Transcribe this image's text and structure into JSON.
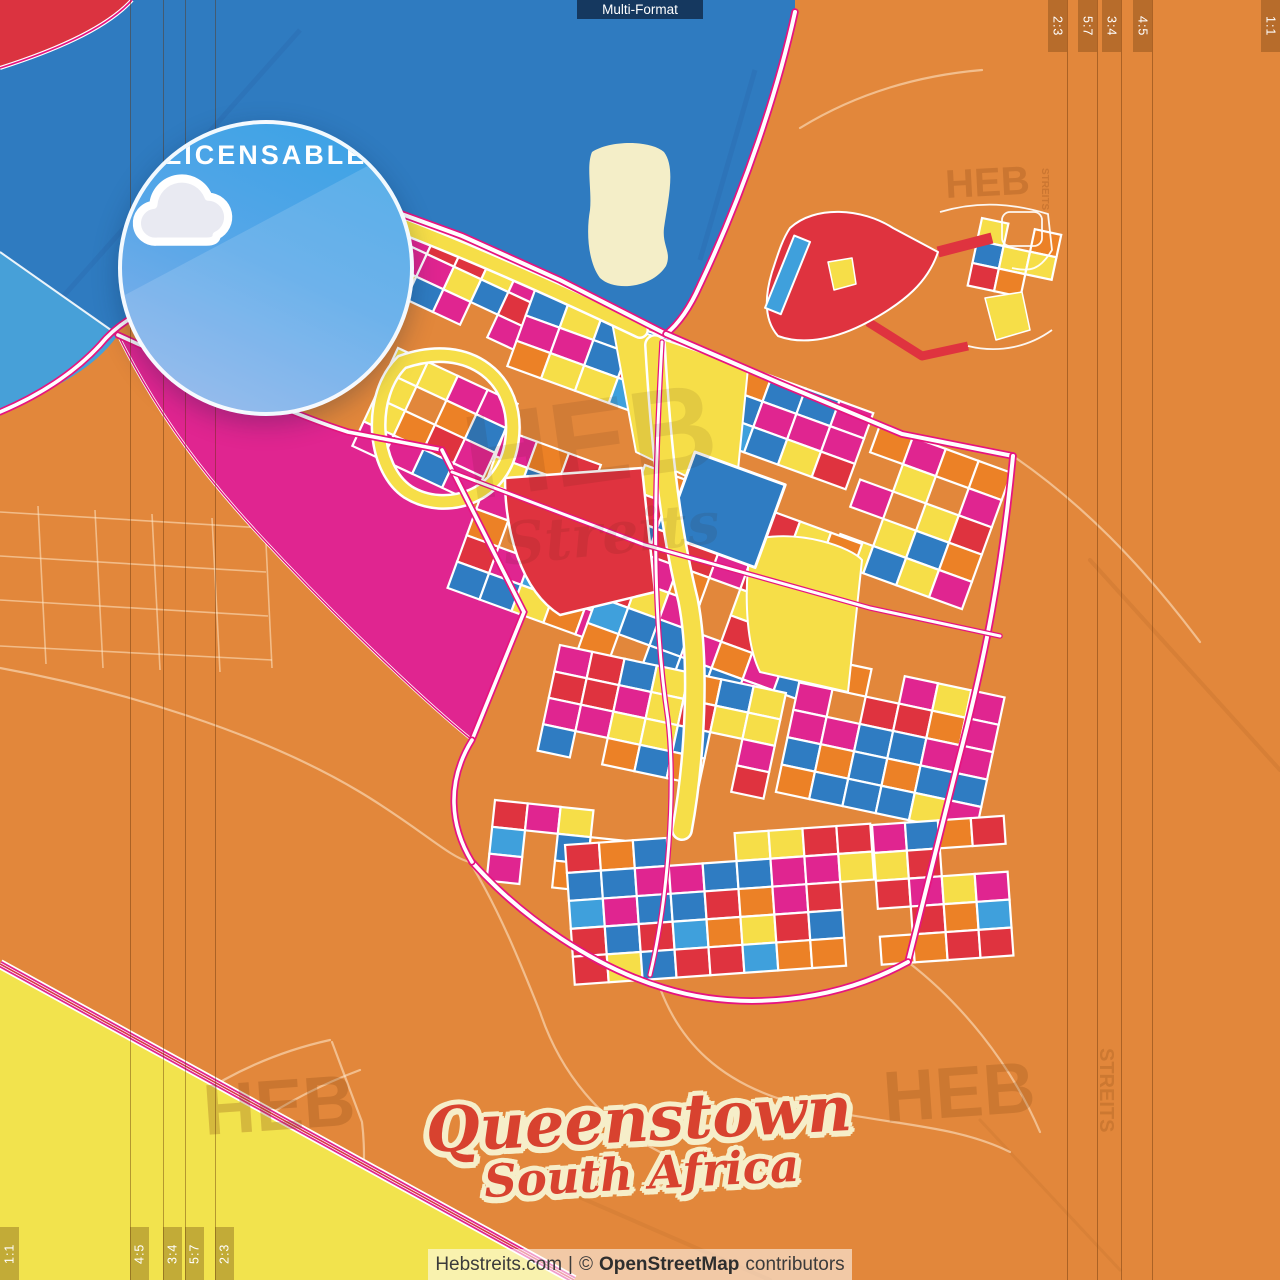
{
  "poster": {
    "format_badge": "Multi-Format",
    "license_badge": "LICENSABLE",
    "title_line1": "Queenstown",
    "title_line2": "South Africa"
  },
  "ratios": {
    "top_right": [
      "2:3",
      "5:7",
      "3:4",
      "4:5"
    ],
    "top_right_edge": "1:1",
    "bottom_left": [
      "4:5",
      "3:4",
      "5:7",
      "2:3"
    ],
    "bottom_left_edge": "1:1"
  },
  "watermarks": {
    "main": "HEB",
    "vertical": "STREITS",
    "script": "Streits"
  },
  "attribution": {
    "site": "Hebstreits.com",
    "divider": "|",
    "copyright_symbol": "©",
    "source": "OpenStreetMap",
    "suffix": "contributors"
  },
  "icons": {
    "cloud_download": "cloud-download-icon"
  },
  "colors": {
    "background": "#E2873B",
    "water": "#2F7BC0",
    "water_light": "#47A0D8",
    "block_yellow": "#F6DE48",
    "block_red": "#DF333F",
    "block_magenta": "#E02590",
    "block_blue": "#2F7CC2",
    "block_blue_light": "#3FA0DC",
    "block_orange": "#EC8126",
    "road_pink": "#E6147F",
    "island_cream": "#F4EEC8",
    "field_yellow": "#F2E34D",
    "badge_blue": "#4BA3E3",
    "title_red": "#D8422F",
    "title_outline": "#F6EEC9"
  }
}
